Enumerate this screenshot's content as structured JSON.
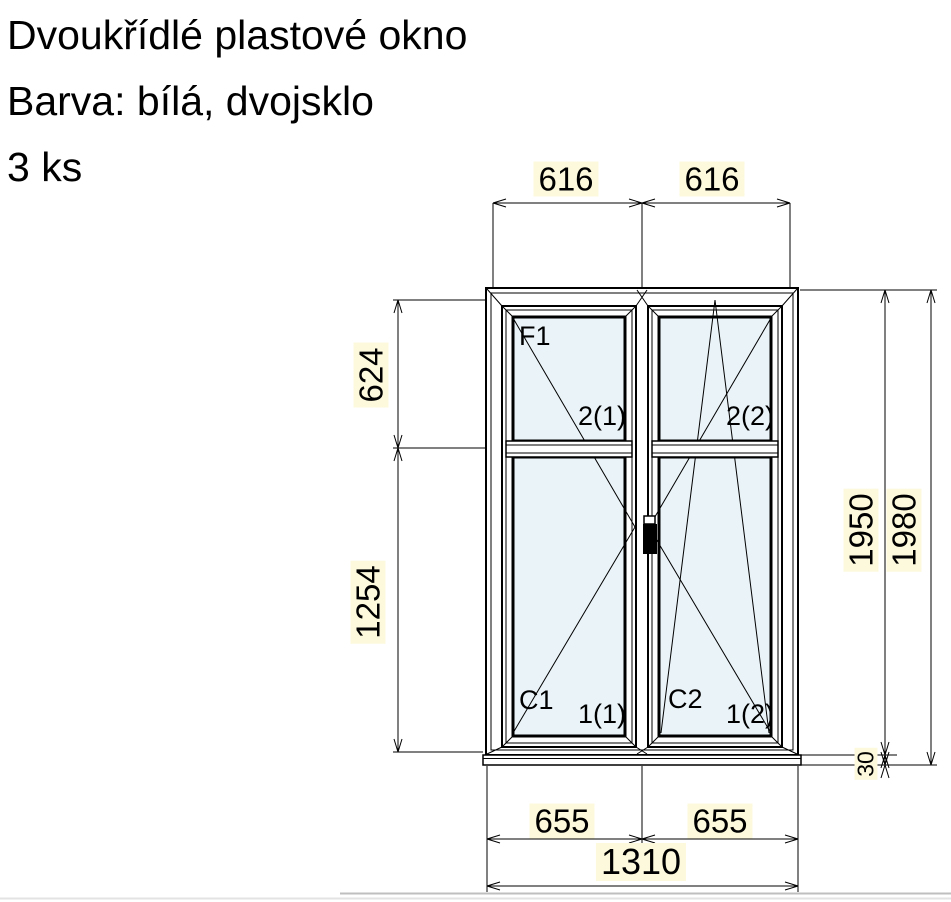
{
  "header": {
    "title": "Dvoukřídlé plastové okno",
    "subtitle": "Barva: bílá, dvojsklo",
    "quantity": "3 ks"
  },
  "dimensions": {
    "sash_width_left": "616",
    "sash_width_right": "616",
    "upper_pane_height": "624",
    "lower_pane_height": "1254",
    "frame_height": "1950",
    "total_height": "1980",
    "sill_height": "30",
    "half_width_left": "655",
    "half_width_right": "655",
    "total_width": "1310"
  },
  "section_labels": {
    "frame_label": "F1",
    "upper_pane_sash1": "2(1)",
    "upper_pane_sash2": "2(2)",
    "sash1_label": "C1",
    "lower_pane_sash1": "1(1)",
    "sash2_label": "C2",
    "lower_pane_sash2": "1(2)"
  },
  "colors": {
    "glass": "#eaf3f8",
    "dim_label_bg": "#fcf9dc",
    "line": "#000000",
    "page_edge": "#c9c9c9"
  }
}
